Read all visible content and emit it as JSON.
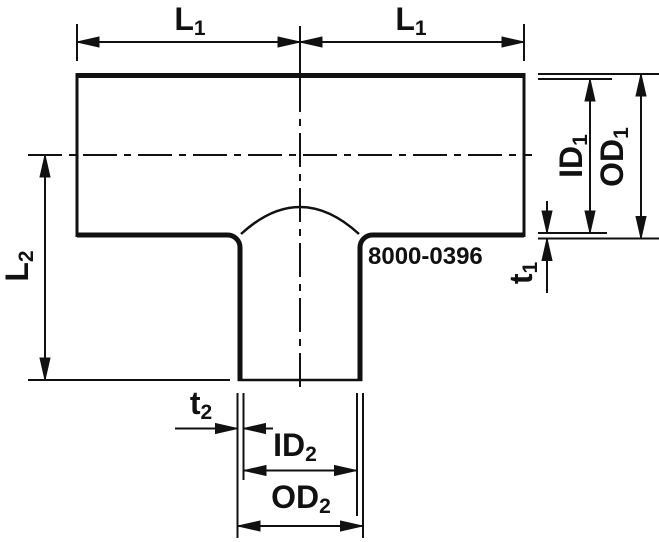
{
  "drawing": {
    "description": "Tee pipe fitting dimensional outline drawing",
    "part_number": "8000-0396",
    "colors": {
      "line": "#111111",
      "background": "#ffffff"
    },
    "labels": {
      "l1_left": {
        "base": "L",
        "sub": "1"
      },
      "l1_right": {
        "base": "L",
        "sub": "1"
      },
      "l2": {
        "base": "L",
        "sub": "2"
      },
      "id1": {
        "base": "ID",
        "sub": "1"
      },
      "od1": {
        "base": "OD",
        "sub": "1"
      },
      "t1": {
        "base": "t",
        "sub": "1"
      },
      "t2": {
        "base": "t",
        "sub": "2"
      },
      "id2": {
        "base": "ID",
        "sub": "2"
      },
      "od2": {
        "base": "OD",
        "sub": "2"
      }
    }
  }
}
